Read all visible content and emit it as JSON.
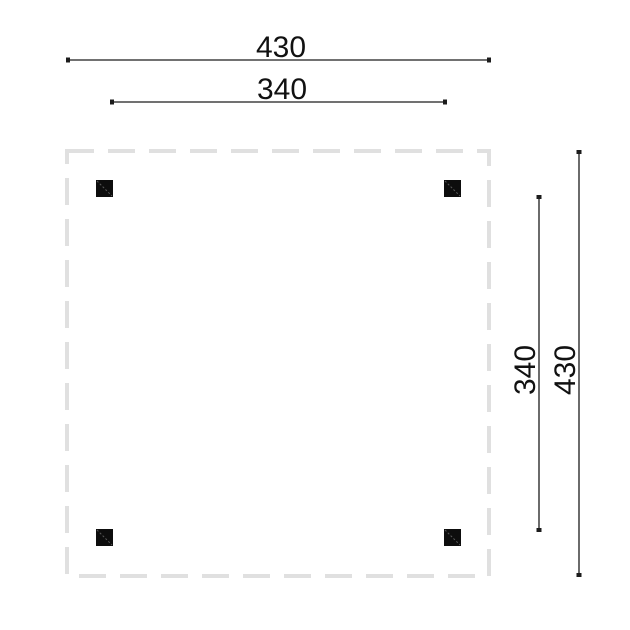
{
  "drawing": {
    "title": "square canopy floor plan",
    "units_note": "",
    "colors": {
      "dimension_line": "#1c1c1c",
      "dimension_text": "#111111",
      "roof_outline_dash": "#e0e0e0",
      "post_fill": "#0d0d0d",
      "post_hatch": "#5a5a5a",
      "background": "#ffffff"
    },
    "dimensions": {
      "top_outer": {
        "label": "430"
      },
      "top_inner": {
        "label": "340"
      },
      "right_inner": {
        "label": "340"
      },
      "right_outer": {
        "label": "430"
      }
    },
    "posts": {
      "count": 4
    }
  }
}
